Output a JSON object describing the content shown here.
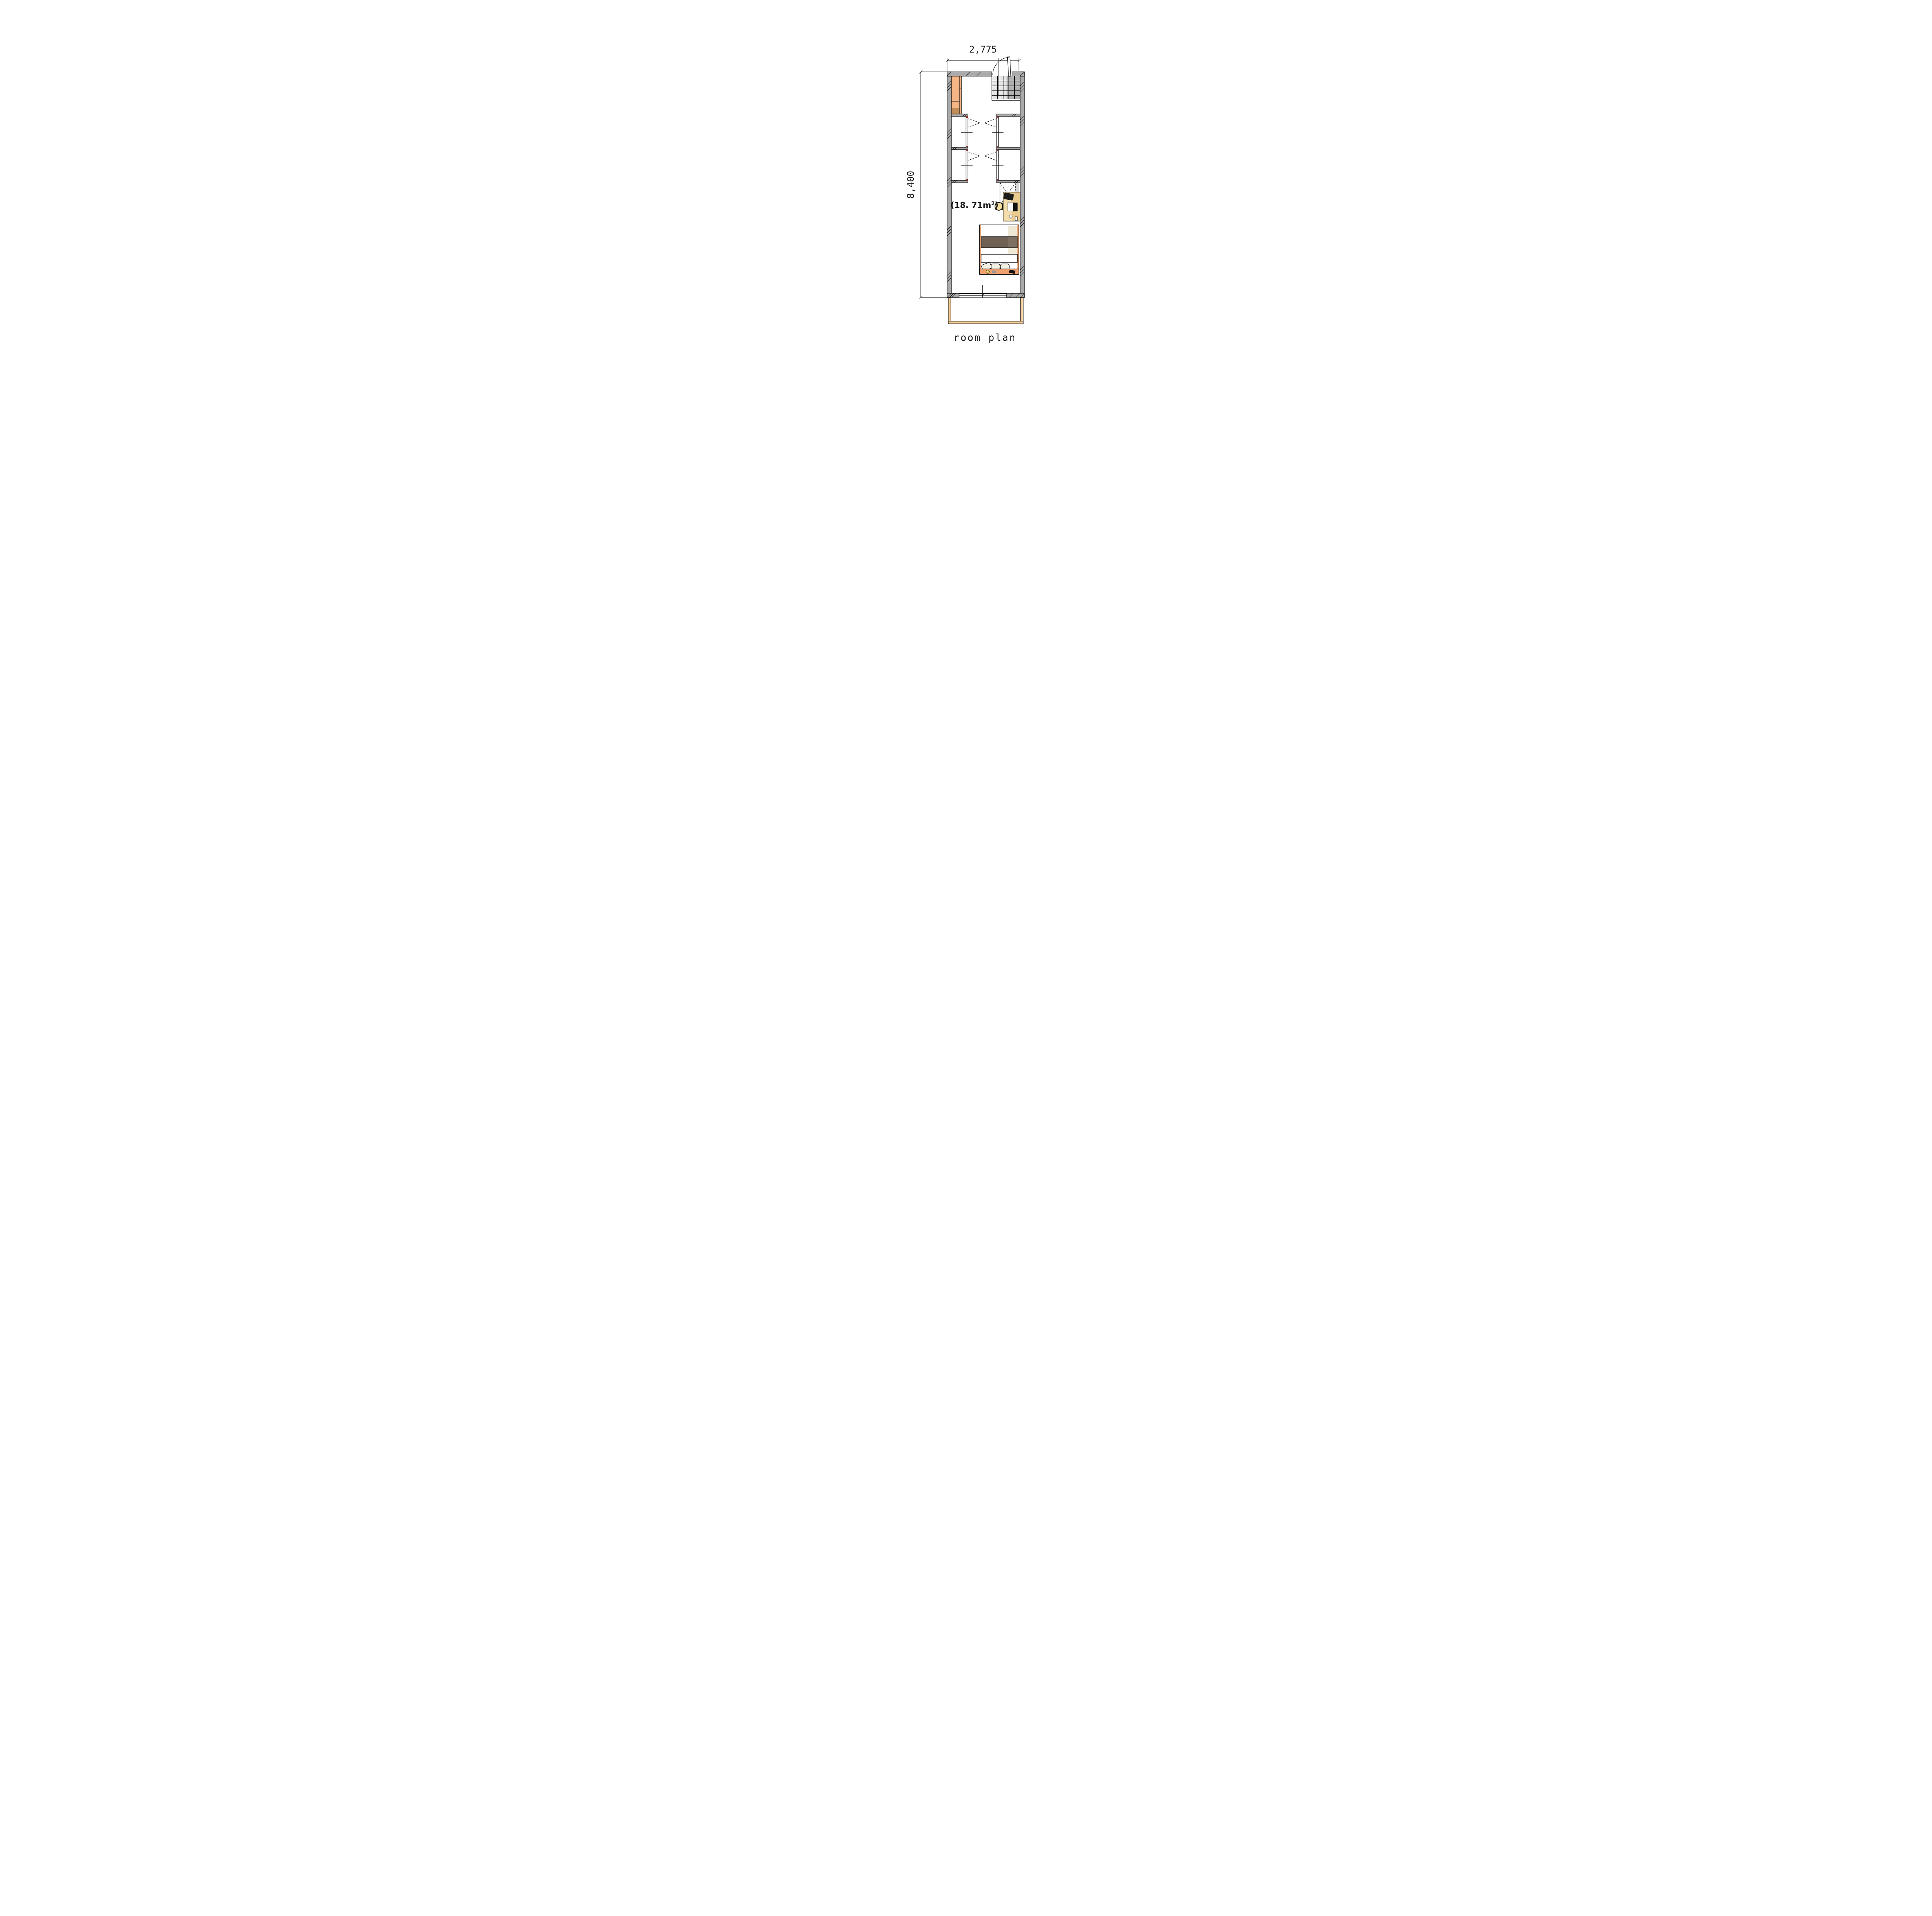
{
  "caption": "room plan",
  "dimensions": {
    "width_label": "2,775",
    "height_label": "8,400"
  },
  "area_label": {
    "prefix": "(18. 71m",
    "sup": "2",
    "suffix": ")"
  },
  "colors": {
    "wall": "#a9a9a9",
    "dim_text": "#1a1a1a",
    "wood": "#f5b585",
    "wood_dark": "#c08c5a",
    "tile_light": "#e7e7e7",
    "tile_dark": "#b2b2b2",
    "desk": "#f3ddad",
    "desk_dark": "#e9cb90",
    "chair": "#1c1c1c",
    "stool": "#f6df9e",
    "bed_frame": "#eda06c",
    "blanket": "#6e6052",
    "blanket_light": "#7d6f62",
    "duvet": "#efe8d6",
    "pillow": "#f3f0e6",
    "headboard": "#f0a26e",
    "clock": "#d8b84a",
    "balcony": "#f4d0a0",
    "door_cap": "#8a3a3a"
  }
}
